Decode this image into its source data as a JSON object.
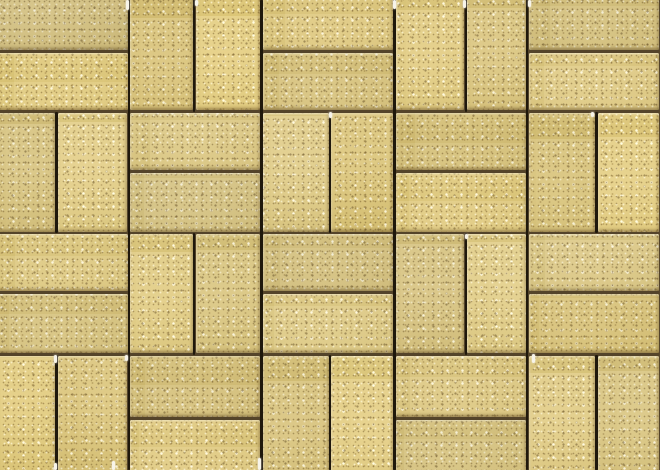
{
  "scene": {
    "type": "photographic texture, top-down view",
    "subject": "concrete paving bricks",
    "description": "Close-up top-down photograph of sand / buff colored rectangular concrete pavers laid in a basketweave pattern with dark recessed joints; speckled sandy surface texture, light bevel highlights on upper-left brick edges and small bright grout glints at the tips of several vertical joints."
  },
  "pattern": {
    "type": "basketweave",
    "rows": 4,
    "cols": 5,
    "brick_count": 40,
    "image_width": 660,
    "image_height": 470,
    "origin_x": -4,
    "origin_y": -10,
    "unit_width": 132.8,
    "unit_height": 121.5,
    "joint_width": 2.6,
    "orientation_rows": [
      [
        "H",
        "V",
        "H",
        "V",
        "H"
      ],
      [
        "V",
        "H",
        "V",
        "H",
        "V"
      ],
      [
        "H",
        "V",
        "H",
        "V",
        "H"
      ],
      [
        "V",
        "H",
        "V",
        "H",
        "V"
      ]
    ],
    "v_mid_offset_by_col": [
      -6,
      -1,
      2,
      5,
      3
    ],
    "h_mid_offset_by_row": [
      1,
      -1,
      -1,
      3
    ]
  },
  "colors": {
    "brick_base": "#d5c17b",
    "brick_light": "#e3d28f",
    "brick_shadow": "#c4ae63",
    "speck_dark": "#7c6333",
    "speck_light": "#f6efcf",
    "grout_horizontal": "#54442a",
    "grout_vertical": "#1f180c",
    "glint": "#f7f4ea"
  },
  "glints": [
    {
      "x": 127,
      "y": 0,
      "h": 10
    },
    {
      "x": 196,
      "y": 0,
      "h": 6
    },
    {
      "x": 394,
      "y": 0,
      "h": 9
    },
    {
      "x": 464,
      "y": 0,
      "h": 8
    },
    {
      "x": 529,
      "y": 0,
      "h": 7
    },
    {
      "x": 330,
      "y": 112,
      "h": 6
    },
    {
      "x": 592,
      "y": 112,
      "h": 5
    },
    {
      "x": 466,
      "y": 234,
      "h": 5
    },
    {
      "x": 55,
      "y": 355,
      "h": 8
    },
    {
      "x": 126,
      "y": 355,
      "h": 6
    },
    {
      "x": 533,
      "y": 354,
      "h": 9
    },
    {
      "x": 55,
      "y": 463,
      "h": 7
    },
    {
      "x": 113,
      "y": 461,
      "h": 9
    },
    {
      "x": 259,
      "y": 458,
      "h": 12
    }
  ]
}
